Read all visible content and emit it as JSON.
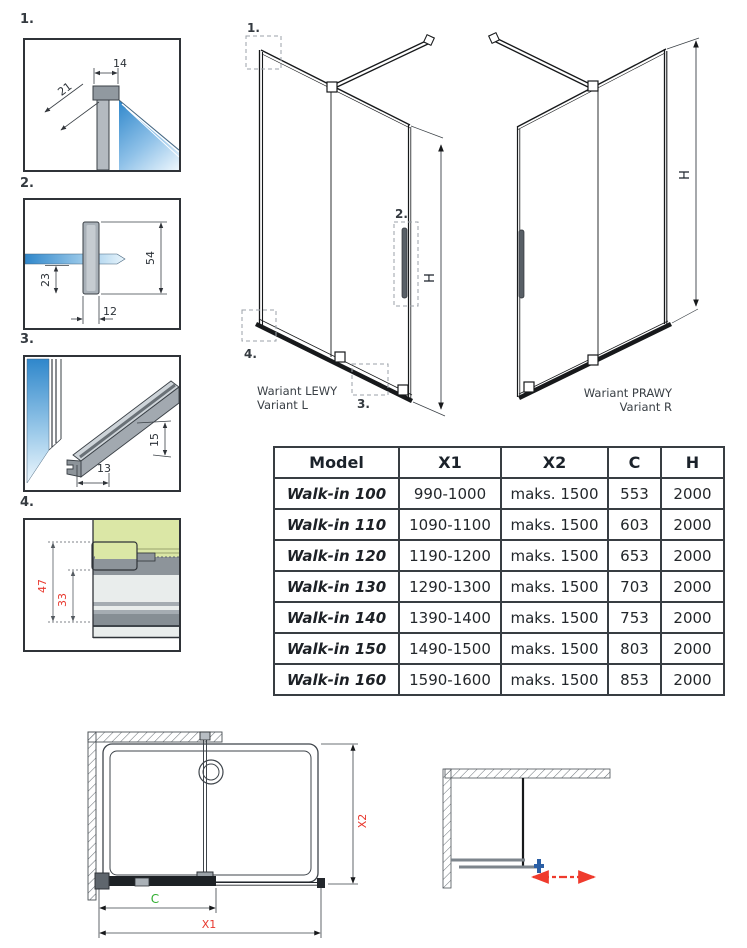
{
  "details": {
    "d1": {
      "label": "1.",
      "dim_width": "14",
      "dim_depth": "21"
    },
    "d2": {
      "label": "2.",
      "dim_height": "54",
      "dim_inner": "23",
      "dim_width": "12"
    },
    "d3": {
      "label": "3.",
      "dim_width": "13",
      "dim_height": "15"
    },
    "d4": {
      "label": "4.",
      "dim_total": "47",
      "dim_inner": "33"
    }
  },
  "variant_left": {
    "title": "Wariant LEWY",
    "subtitle": "Variant L",
    "h_label": "H",
    "callout_1": "1.",
    "callout_2": "2.",
    "callout_3": "3.",
    "callout_4": "4."
  },
  "variant_right": {
    "title": "Wariant PRAWY",
    "subtitle": "Variant R",
    "h_label": "H"
  },
  "table": {
    "headers": {
      "model": "Model",
      "x1": "X1",
      "x2": "X2",
      "c": "C",
      "h": "H"
    },
    "rows": [
      {
        "model": "Walk-in 100",
        "x1": "990-1000",
        "x2": "maks. 1500",
        "c": "553",
        "h": "2000"
      },
      {
        "model": "Walk-in 110",
        "x1": "1090-1100",
        "x2": "maks. 1500",
        "c": "603",
        "h": "2000"
      },
      {
        "model": "Walk-in 120",
        "x1": "1190-1200",
        "x2": "maks. 1500",
        "c": "653",
        "h": "2000"
      },
      {
        "model": "Walk-in 130",
        "x1": "1290-1300",
        "x2": "maks. 1500",
        "c": "703",
        "h": "2000"
      },
      {
        "model": "Walk-in 140",
        "x1": "1390-1400",
        "x2": "maks. 1500",
        "c": "753",
        "h": "2000"
      },
      {
        "model": "Walk-in 150",
        "x1": "1490-1500",
        "x2": "maks. 1500",
        "c": "803",
        "h": "2000"
      },
      {
        "model": "Walk-in 160",
        "x1": "1590-1600",
        "x2": "maks. 1500",
        "c": "853",
        "h": "2000"
      }
    ]
  },
  "plan": {
    "c_label": "C",
    "x1_label": "X1",
    "x2_label": "X2"
  },
  "colors": {
    "dim_red": "#e8281e",
    "dim_green": "#2fbe2f",
    "glass_blue": "#2f87cb",
    "line_dark": "#17191b",
    "detail4_green": "#dbe7a6",
    "handle_blue": "#2b5fa5",
    "slide_arrow_red": "#ef3b2d",
    "table_border": "#383d42"
  }
}
